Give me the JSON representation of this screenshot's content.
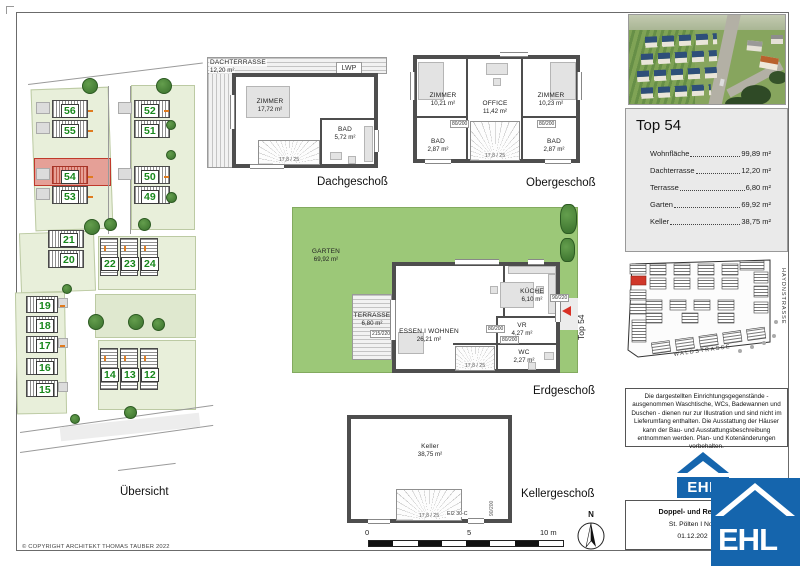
{
  "sheet": {
    "copyright": "© COPYRIGHT ARCHITEKT THOMAS TAUBER 2022"
  },
  "overview": {
    "label": "Übersicht",
    "lots": [
      "56",
      "55",
      "54",
      "53",
      "52",
      "51",
      "50",
      "49",
      "21",
      "20",
      "22",
      "23",
      "24",
      "19",
      "18",
      "17",
      "16",
      "15",
      "14",
      "13",
      "12"
    ],
    "highlighted_lot": "54"
  },
  "floors": {
    "dach": {
      "label": "Dachgeschoß",
      "terrace": {
        "name": "DACHTERRASSE",
        "area": "12,20 m²"
      },
      "lwp": "LWP",
      "zimmer": {
        "name": "ZIMMER",
        "area": "17,72 m²"
      },
      "bad": {
        "name": "BAD",
        "area": "5,72 m²"
      },
      "stairs": "17,8 / 25"
    },
    "ober": {
      "label": "Obergeschoß",
      "zimmer1": {
        "name": "ZIMMER",
        "area": "10,21 m²"
      },
      "office": {
        "name": "OFFICE",
        "area": "11,42 m²"
      },
      "zimmer2": {
        "name": "ZIMMER",
        "area": "10,23 m²"
      },
      "bad1": {
        "name": "BAD",
        "area": "2,87 m²"
      },
      "bad2": {
        "name": "BAD",
        "area": "2,87 m²"
      },
      "door_dim": "80/200",
      "stairs": "17,8 / 25"
    },
    "erd": {
      "label": "Erdgeschoß",
      "garten": {
        "name": "GARTEN",
        "area": "69,92 m²"
      },
      "terrasse": {
        "name": "TERRASSE",
        "area": "6,80 m²"
      },
      "wohnen": {
        "name": "ESSEN I WOHNEN",
        "area": "26,21 m²"
      },
      "kueche": {
        "name": "KÜCHE",
        "area": "6,10 m²"
      },
      "vr": {
        "name": "VR",
        "area": "4,27 m²"
      },
      "wc": {
        "name": "WC",
        "area": "2,27 m²"
      },
      "entry_dim": "90/220",
      "door_dim": "80/200",
      "terrace_dim": "215/220",
      "unit_marker": "Top 54",
      "stairs": "17,8 / 25"
    },
    "keller": {
      "label": "Kellergeschoß",
      "room": {
        "name": "Keller",
        "area": "38,75 m²"
      },
      "door_type": "EI2 30-C",
      "door_dim": "90/200",
      "stairs": "17,8 / 25"
    }
  },
  "scalebar": {
    "start": "0",
    "mid": "5",
    "end": "10 m"
  },
  "compass": {
    "north": "N"
  },
  "unit_panel": {
    "title": "Top 54",
    "items": [
      {
        "label": "Wohnfläche",
        "value": "99,89 m²"
      },
      {
        "label": "Dachterrasse",
        "value": "12,20 m²"
      },
      {
        "label": "Terrasse",
        "value": "6,80 m²"
      },
      {
        "label": "Garten",
        "value": "69,92 m²"
      },
      {
        "label": "Keller",
        "value": "38,75 m²"
      }
    ]
  },
  "keymap": {
    "streets": [
      "HAYDNSTRASSE",
      "WALDSTRASSE"
    ]
  },
  "disclaimer": "Die dargestellten Einrichtungsgegenstände - ausgenommen Waschtische, WCs, Badewannen und Duschen - dienen nur zur Illustration und sind nicht im Lieferumfang enthalten. Die Ausstattung der Häuser kann der Bau- und Ausstattungsbeschreibung entnommen werden. Plan- und Kotenänderungen vorbehalten.",
  "titleblock": {
    "line1": "Doppel- und Reihen",
    "line2": "St. Pölten I Nov",
    "line3": "01.12.202"
  },
  "logo": {
    "text": "EHL"
  },
  "colors": {
    "ehl_blue": "#1565ad",
    "accent_red": "#d93025",
    "garden_green": "#9cc878",
    "parcel_green": "#e8efda",
    "lot_red": "#e5a097"
  }
}
